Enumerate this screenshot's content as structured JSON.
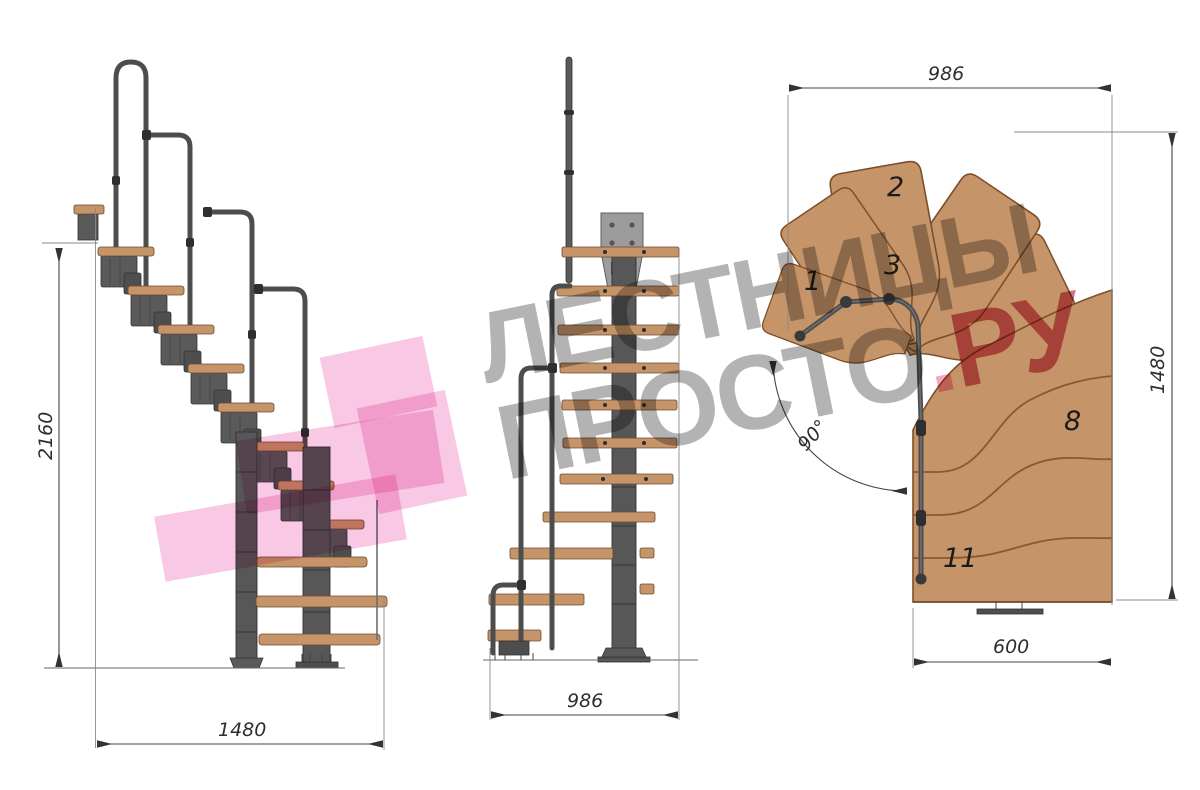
{
  "drawing": {
    "type": "staircase-technical-drawing",
    "views": {
      "side": {
        "height_mm": "2160",
        "width_mm": "1480"
      },
      "front": {
        "width_mm": "986"
      },
      "plan": {
        "width_mm": "986",
        "depth_mm": "1480",
        "exit_width_mm": "600",
        "turn_angle": "90°",
        "tread_labels": [
          "1",
          "2",
          "3",
          "8",
          "11"
        ]
      }
    }
  },
  "watermark": {
    "line1": "ЛЕСТНИЦЫ",
    "brand_gray": "ПРОСТО",
    "brand_dot": ".",
    "brand_accent": "РУ"
  },
  "colors": {
    "wood": "#c59468",
    "wood-edge": "#7d4f2a",
    "metal": "#5a5a5a",
    "metal-dark": "#333333",
    "plate": "#9c9c9c",
    "wm-gray": "#a6a6a6",
    "wm-pink": "#f6bade",
    "wm-accent": "#cf5570",
    "wm-dot": "#f099bb"
  }
}
